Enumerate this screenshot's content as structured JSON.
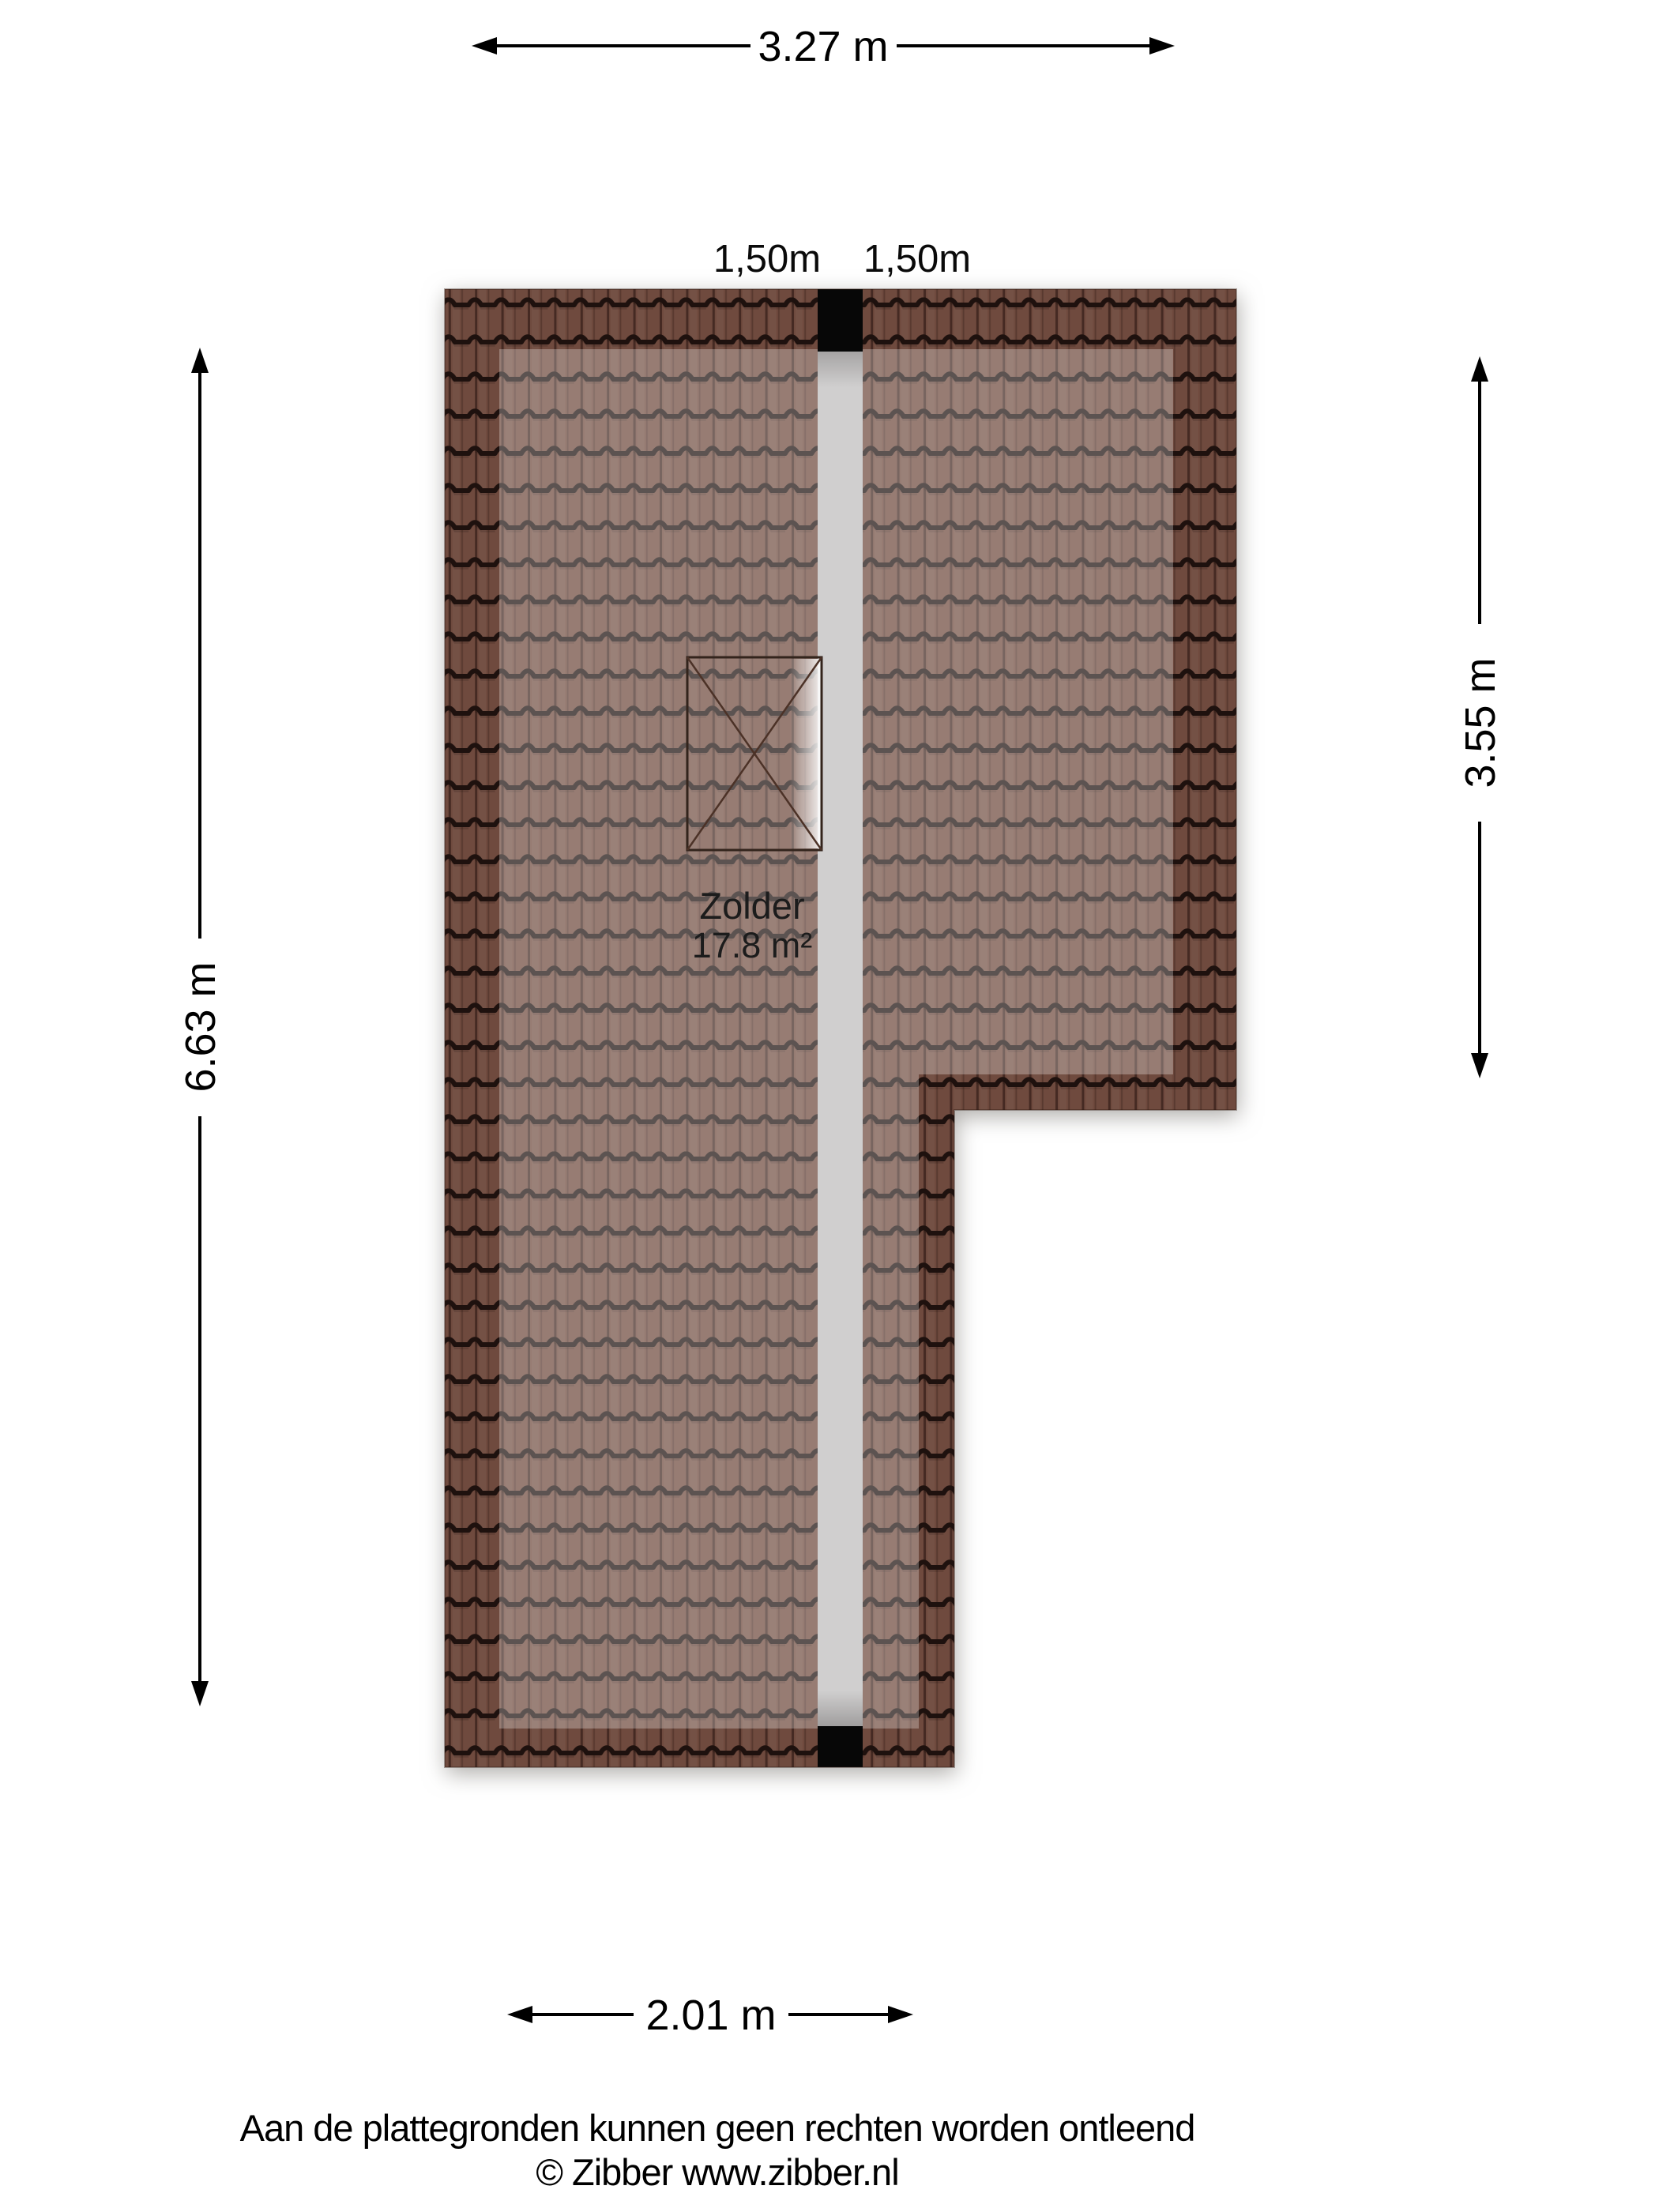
{
  "floor_plan": {
    "room": {
      "name": "Zolder",
      "area": "17.8 m²"
    },
    "dimensions": {
      "width_top": "3.27 m",
      "height_left": "6.63 m",
      "height_right": "3.55 m",
      "width_bottom": "2.01 m",
      "headroom_line_left": "1,50m",
      "headroom_line_right": "1,50m"
    },
    "colors": {
      "roof_tile": "#8a5f50",
      "roof_tile_border_zone": "#6f4a3e",
      "tile_groove": "#1e1310",
      "ridge_walkway": "#d0cfcf",
      "chimney_block": "#070707",
      "dimension_ink": "#000000"
    }
  },
  "footer": {
    "disclaimer": "Aan de plattegronden kunnen geen rechten worden ontleend",
    "copyright": "© Zibber www.zibber.nl"
  }
}
